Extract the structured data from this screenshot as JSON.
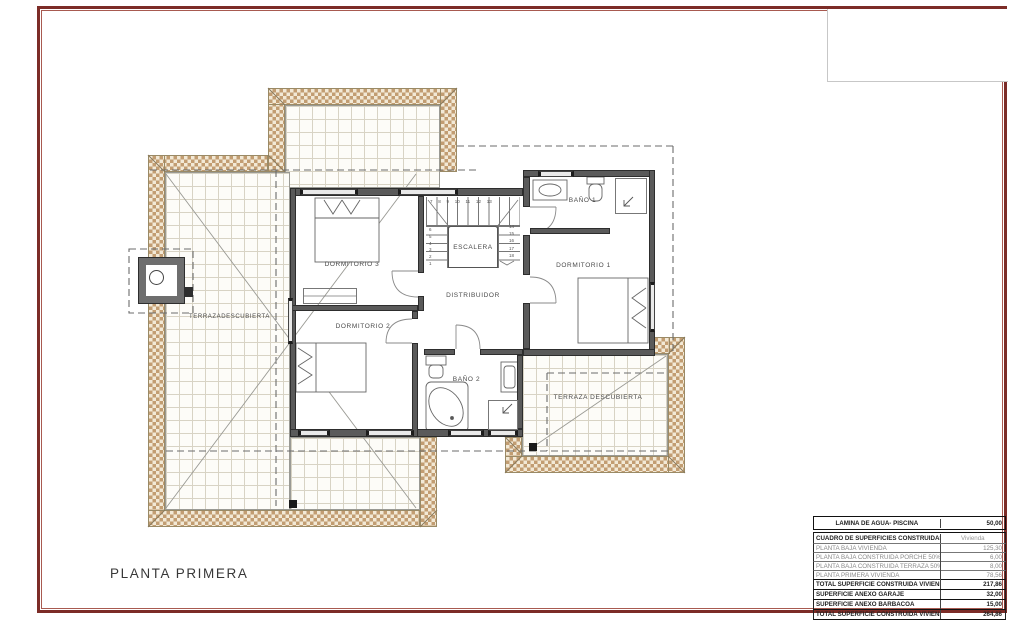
{
  "page": {
    "title": "PLANTA PRIMERA"
  },
  "plan": {
    "rooms": {
      "dormitorio1": "DORMITORIO 1",
      "dormitorio2": "DORMITORIO 2",
      "dormitorio3": "DORMITORIO 3",
      "bano1": "BAÑO 1",
      "bano2": "BAÑO 2",
      "escalera": "ESCALERA",
      "distribuidor": "DISTRIBUIDOR",
      "terraza_izquierda": "TERRAZADESCUBIERTA",
      "terraza_derecha": "TERRAZA DESCUBIERTA"
    },
    "stair_numbers": {
      "top": "7 8 9 10 11 12 13",
      "right": "14\n15\n16\n17\n18",
      "left": "6\n5\n4\n3\n2\n1"
    }
  },
  "surface_table": {
    "water_row": {
      "label": "LAMINA DE AGUA- PISCINA",
      "value": "50,00"
    },
    "header": {
      "label": "CUADRO DE SUPERFICIES CONSTRUIDAS (m2)",
      "value": "Vivienda"
    },
    "rows": [
      {
        "label": "PLANTA BAJA VIVIENDA",
        "value": "125,30"
      },
      {
        "label": "PLANTA BAJA CONSTRUIDA PORCHE 50%",
        "value": "6,00"
      },
      {
        "label": "PLANTA BAJA CONSTRUIDA TERRAZA 50%",
        "value": "8,00"
      },
      {
        "label": "PLANTA PRIMERA VIVIENDA",
        "value": "78,56"
      },
      {
        "label": "TOTAL SUPERFICIE CONSTRUIDA VIVIENDA",
        "value": "217,86"
      },
      {
        "label": "SUPERFICIE ANEXO GARAJE",
        "value": "32,00"
      },
      {
        "label": "SUPERFICIE ANEXO BARBACOA",
        "value": "15,00"
      },
      {
        "label": "TOTAL SUPERFICIE CONSTRUIDA VIVIENDA + ANEXOS",
        "value": "264,86"
      }
    ]
  },
  "colors": {
    "frame": "#7c2c27",
    "hatch": "#c29d72",
    "wall": "#5a5a5a"
  }
}
